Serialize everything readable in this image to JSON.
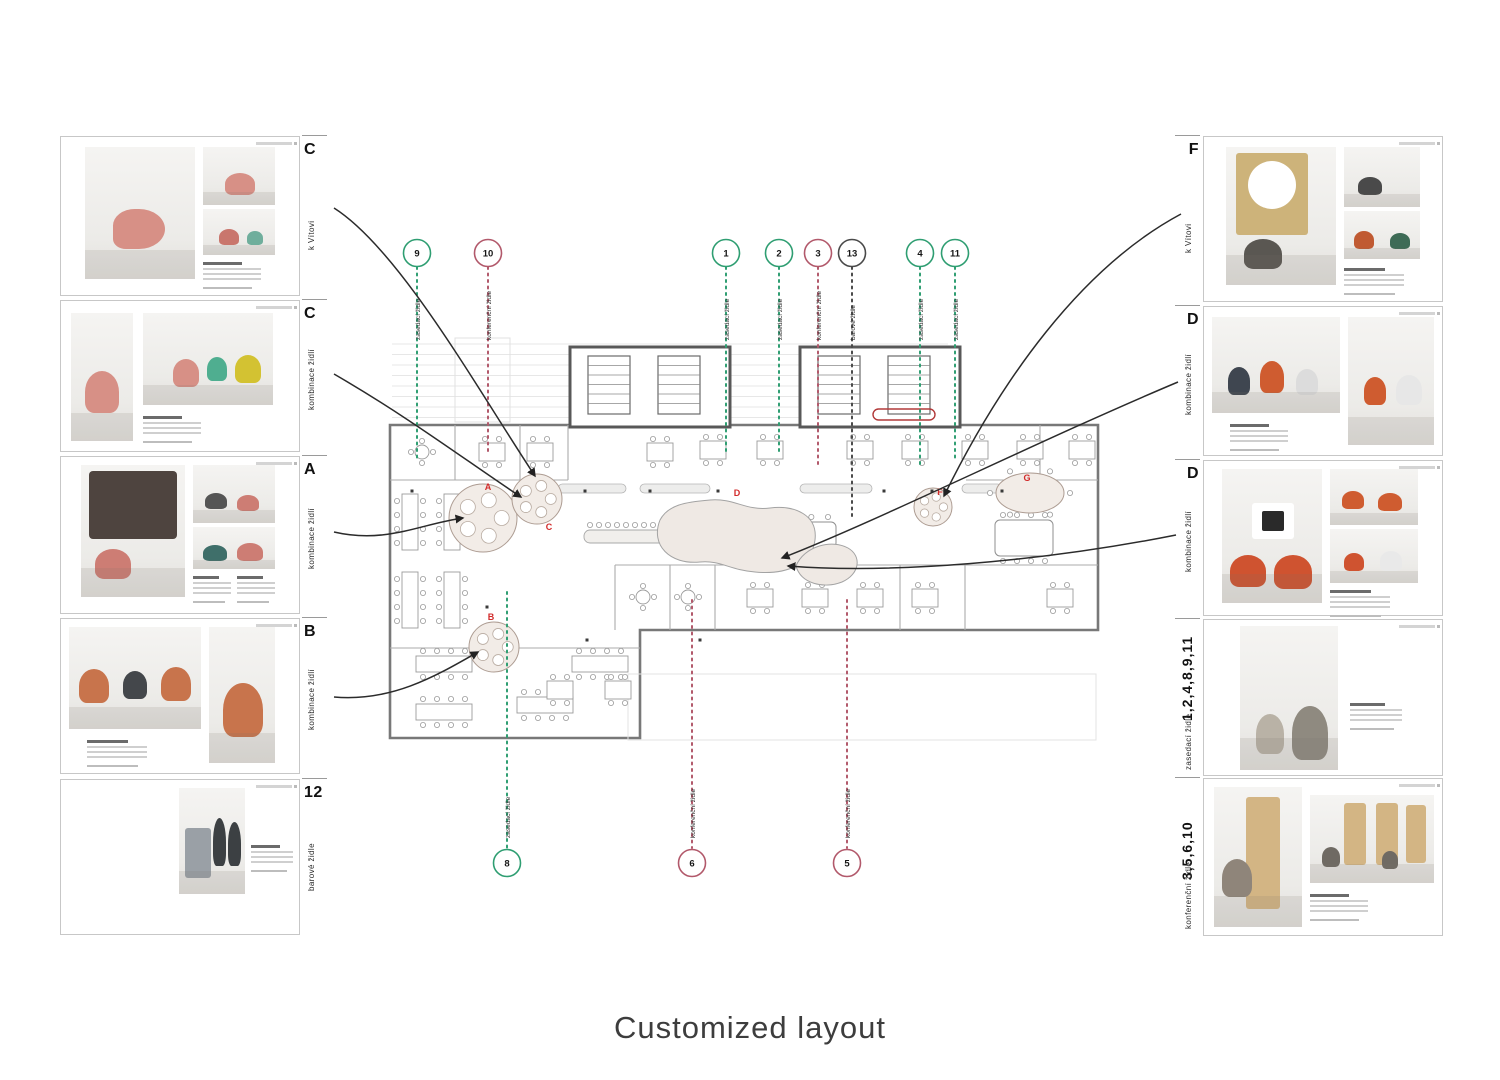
{
  "caption": "Customized layout",
  "palette": {
    "green": "#2f9e72",
    "pink": "#b2596b",
    "dark": "#4a4a4a",
    "red": "#d22b2b",
    "wall": "#787878",
    "connector": "#2b2b2b"
  },
  "cards": {
    "left": [
      {
        "letter": "C",
        "side_label": "k Vítovi"
      },
      {
        "letter": "C",
        "side_label": "kombinace židlí"
      },
      {
        "letter": "A",
        "side_label": "kombinace židlí"
      },
      {
        "letter": "B",
        "side_label": "kombinace židlí"
      },
      {
        "letter": "12",
        "side_label": "barové židle"
      }
    ],
    "right": [
      {
        "letter": "F",
        "side_label": "k Vítovi"
      },
      {
        "letter": "D",
        "side_label": "kombinace židlí"
      },
      {
        "letter": "D",
        "side_label": "kombinace židlí"
      },
      {
        "letter": "1,2,4,8,9,11",
        "side_label": "zasedací židle"
      },
      {
        "letter": "3,5,6,10",
        "side_label": "konferenční židle"
      }
    ]
  },
  "markers": {
    "top_cy": 253,
    "bottom_cy": 863,
    "top": [
      {
        "n": "9",
        "c": "green",
        "x": 417,
        "end": 462,
        "label": "zasedací židle"
      },
      {
        "n": "10",
        "c": "pink",
        "x": 488,
        "end": 455,
        "label": "konferenční židle"
      },
      {
        "n": "1",
        "c": "green",
        "x": 726,
        "end": 452,
        "label": "zasedací židle"
      },
      {
        "n": "2",
        "c": "green",
        "x": 779,
        "end": 455,
        "label": "zasedací židle"
      },
      {
        "n": "3",
        "c": "pink",
        "x": 818,
        "end": 468,
        "label": "konferenční židle"
      },
      {
        "n": "13",
        "c": "dark",
        "x": 852,
        "end": 520,
        "label": "barové židle"
      },
      {
        "n": "4",
        "c": "green",
        "x": 920,
        "end": 465,
        "label": "zasedací židle"
      },
      {
        "n": "11",
        "c": "green",
        "x": 955,
        "end": 462,
        "label": "zasedací židle"
      }
    ],
    "bottom": [
      {
        "n": "8",
        "c": "green",
        "x": 507,
        "end": 592,
        "label": "zasedací židle"
      },
      {
        "n": "6",
        "c": "pink",
        "x": 692,
        "end": 600,
        "label": "konferenční židle"
      },
      {
        "n": "5",
        "c": "pink",
        "x": 847,
        "end": 600,
        "label": "konferenční židle"
      }
    ]
  },
  "plan_letters": [
    {
      "t": "A",
      "x": 488,
      "y": 490
    },
    {
      "t": "C",
      "x": 549,
      "y": 530
    },
    {
      "t": "B",
      "x": 491,
      "y": 620
    },
    {
      "t": "D",
      "x": 737,
      "y": 496
    },
    {
      "t": "F",
      "x": 940,
      "y": 495
    },
    {
      "t": "G",
      "x": 1027,
      "y": 481
    }
  ]
}
